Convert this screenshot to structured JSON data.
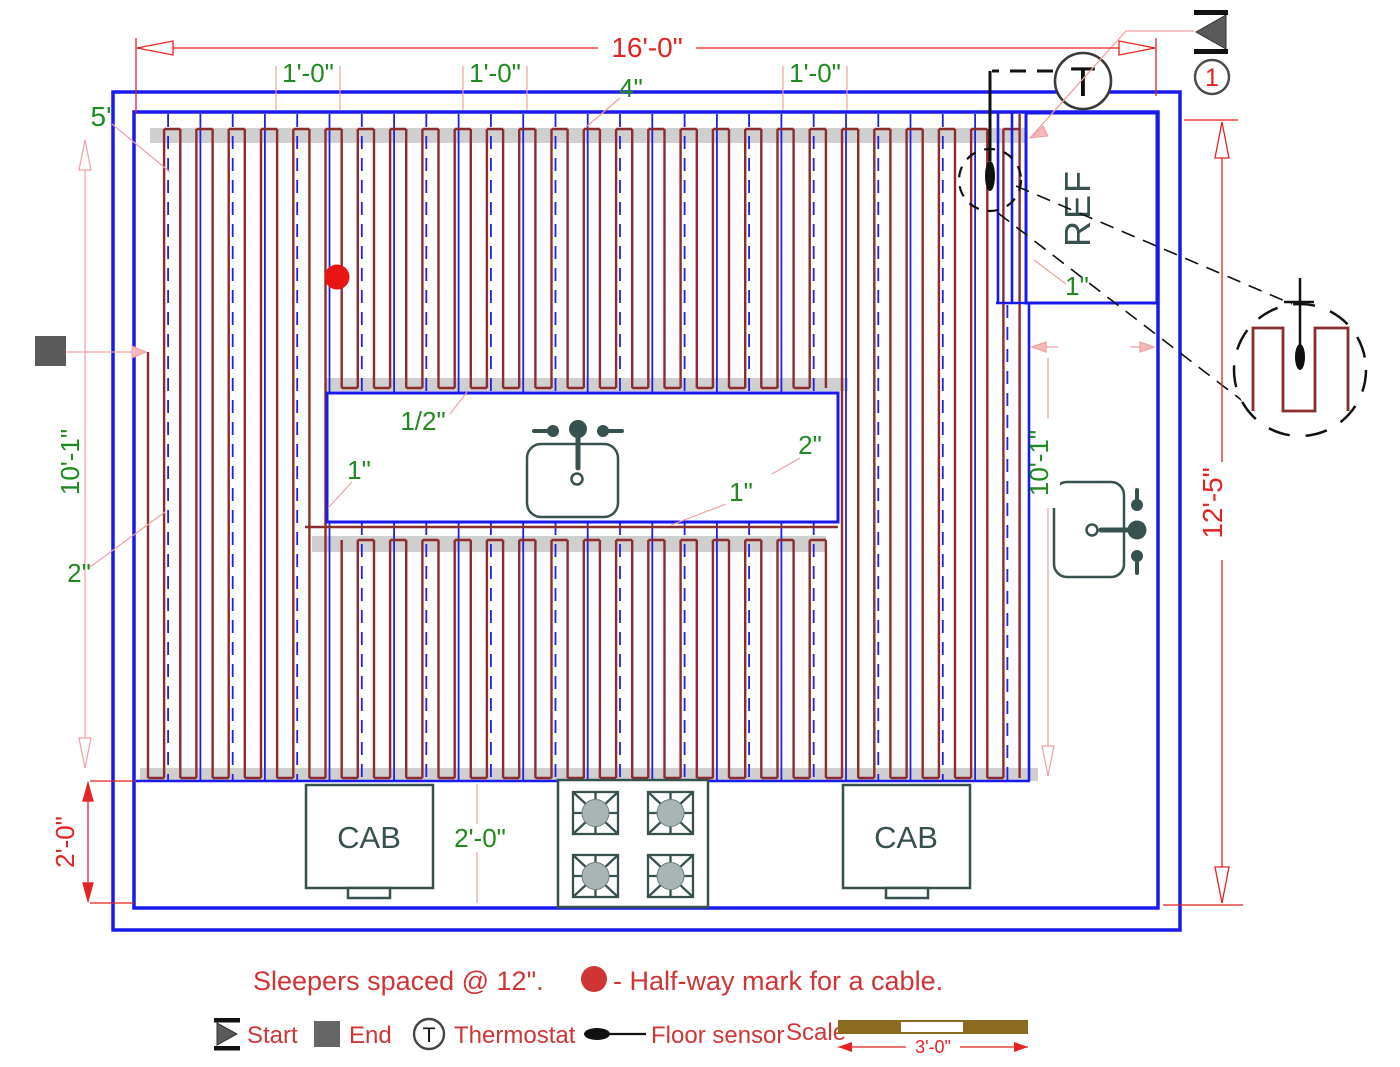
{
  "dims": {
    "total_width": "16'-0\"",
    "total_height": "12'-5\"",
    "spacing1": "1'-0\"",
    "spacing2": "1'-0\"",
    "spacing3": "1'-0\"",
    "top_gap": "4\"",
    "left_offset": "5'",
    "left_height": "10'-1\"",
    "left_gap": "2\"",
    "counter_depth_red": "2'-0\"",
    "counter_depth_green": "2'-0\"",
    "island_top_gap": "1/2\"",
    "island_left_gap": "1\"",
    "island_bottom_gap": "1\"",
    "island_right_gap": "2\"",
    "ref_gap": "1\"",
    "right_counter_width": "2'-1\"",
    "right_height": "10'-1\"",
    "scale_length": "3'-0\""
  },
  "labels": {
    "ref": "REF",
    "cab_left": "CAB",
    "cab_right": "CAB",
    "thermostat_symbol": "T",
    "detail_number": "1"
  },
  "notes": {
    "sleepers": "Sleepers spaced @ 12\".",
    "halfway": "- Half-way mark for a cable."
  },
  "legend": {
    "start": "Start",
    "end": "End",
    "thermostat": "Thermostat",
    "floor_sensor": "Floor sensor",
    "scale": "Scale"
  },
  "colors": {
    "wall_blue": "#1a1aee",
    "grid_blue": "#2020e8",
    "cable_maroon": "#8b2d2d",
    "dim_red": "#e32222",
    "dim_green": "#1e8a1e",
    "extension_pink": "#f0a0a0",
    "fixture_slate": "#37514f",
    "sleeper_gray": "#cfcfcf",
    "scale_bar_brown": "#8a6b1f",
    "halfway_dot_red": "#e91515"
  }
}
